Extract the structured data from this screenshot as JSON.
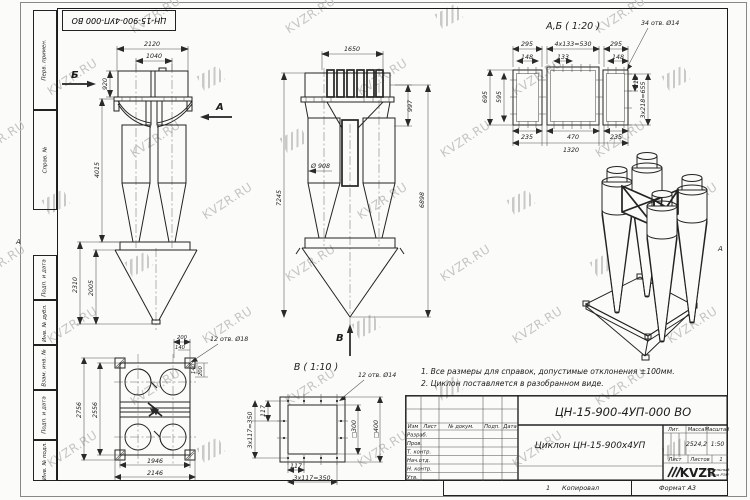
{
  "watermark": {
    "text": "KVZR.RU"
  },
  "frame": {
    "doc_number_top": "ЦН-15-900-4УП-000 ВО",
    "zone": "А",
    "stamps": [
      "Перв. примен.",
      "Справ. №",
      "Подп. и дата",
      "Инв. № дубл.",
      "Взам. инв. №",
      "Подп. и дата",
      "Инв. № подл."
    ]
  },
  "d": {
    "side": {
      "w1": "2120",
      "w2": "1040",
      "h1": "920",
      "h2": "4015",
      "h3": "2310",
      "h4": "2005",
      "la": "А",
      "lb": "Б"
    },
    "front": {
      "w1": "1650",
      "h1": "997",
      "dia": "Ø 908",
      "ht": "7245",
      "hr": "6898",
      "lv": "В"
    },
    "ab": {
      "t": "А,Б ( 1:20 )",
      "n": "34 отв. Ø14",
      "a1": "295",
      "a2": "4x133=530",
      "a3": "295",
      "b1": "148",
      "b2": "133",
      "b3": "148",
      "l1": "695",
      "l2": "595",
      "r1": "218",
      "r2": "3x218=655",
      "c1": "235",
      "c2": "470",
      "c3": "235",
      "c4": "1320"
    },
    "plan": {
      "n": "12 отв. Ø18",
      "t1": "200",
      "t2": "140",
      "r1": "140",
      "r2": "200",
      "l1": "2756",
      "l2": "2556",
      "b1": "1946",
      "b2": "2146"
    },
    "v": {
      "t": "В ( 1:10 )",
      "n": "12 отв. Ø14",
      "l1": "117",
      "l2": "3x117=350",
      "b1": "117",
      "b2": "3x117=350",
      "s1": "□300",
      "s2": "□400"
    }
  },
  "notes": {
    "n1": "1. Все размеры для справок, допустимые отклонения ±100мм.",
    "n2": "2. Циклон поставляется в разобранном виде."
  },
  "title_block": {
    "doc_number": "ЦН-15-900-4УП-000 ВО",
    "name": "Циклон ЦН-15-900х4УП",
    "h_izm": "Изм",
    "h_list": "Лист",
    "h_doc": "№ докум.",
    "h_podp": "Подп.",
    "h_data": "Дата",
    "r1": "Разраб.",
    "r2": "Пров.",
    "r3": "Т. контр.",
    "r4": "Нач.отд.",
    "r5": "Н. контр.",
    "r6": "Утв.",
    "lit": "Лит.",
    "mass": "Масса",
    "scale": "Масштаб",
    "mass_v": "2524,2",
    "scale_v": "1:50",
    "sheet": "Лист",
    "sheets": "Листов",
    "sheets_v": "1",
    "logo": "KVZR",
    "co1": "Котельный",
    "co2": "завод РЭП",
    "num": "1",
    "copied": "Копировал",
    "fmt": "Формат А3"
  }
}
